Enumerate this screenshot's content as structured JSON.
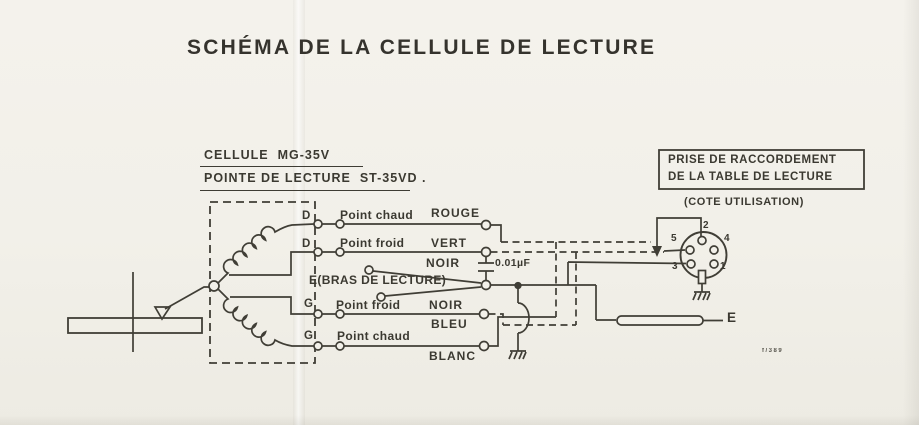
{
  "title": "SCHÉMA DE LA CELLULE DE LECTURE",
  "cartridge": {
    "model_line": "CELLULE  MG-35V",
    "stylus_line": "POINTE DE LECTURE  ST-35VD .",
    "terminals": {
      "d1": "D",
      "d2": "D",
      "g1": "G",
      "g2": "G"
    }
  },
  "wires": {
    "right_hot": {
      "desc": "Point chaud",
      "color": "ROUGE"
    },
    "right_cold": {
      "desc": "Point froid",
      "color": "VERT"
    },
    "arm": {
      "color": "NOIR",
      "label": "E(BRAS DE LECTURE)"
    },
    "left_cold": {
      "desc": "Point froid",
      "color": "NOIR",
      "cable_color": "BLEU"
    },
    "left_hot": {
      "desc": "Point chaud",
      "cable_color": "BLANC"
    }
  },
  "capacitor": {
    "value": "0.01µF"
  },
  "connector": {
    "title_line1": "PRISE DE RACCORDEMENT",
    "title_line2": "DE LA TABLE DE LECTURE",
    "subtitle": "(COTE UTILISATION)",
    "pins": {
      "p1": "1",
      "p2": "2",
      "p3": "3",
      "p4": "4",
      "p5": "5"
    }
  },
  "earth_label": "E",
  "footnote": "f/389",
  "ink_color": "#403e36",
  "paper_color": "#f2f0e9"
}
